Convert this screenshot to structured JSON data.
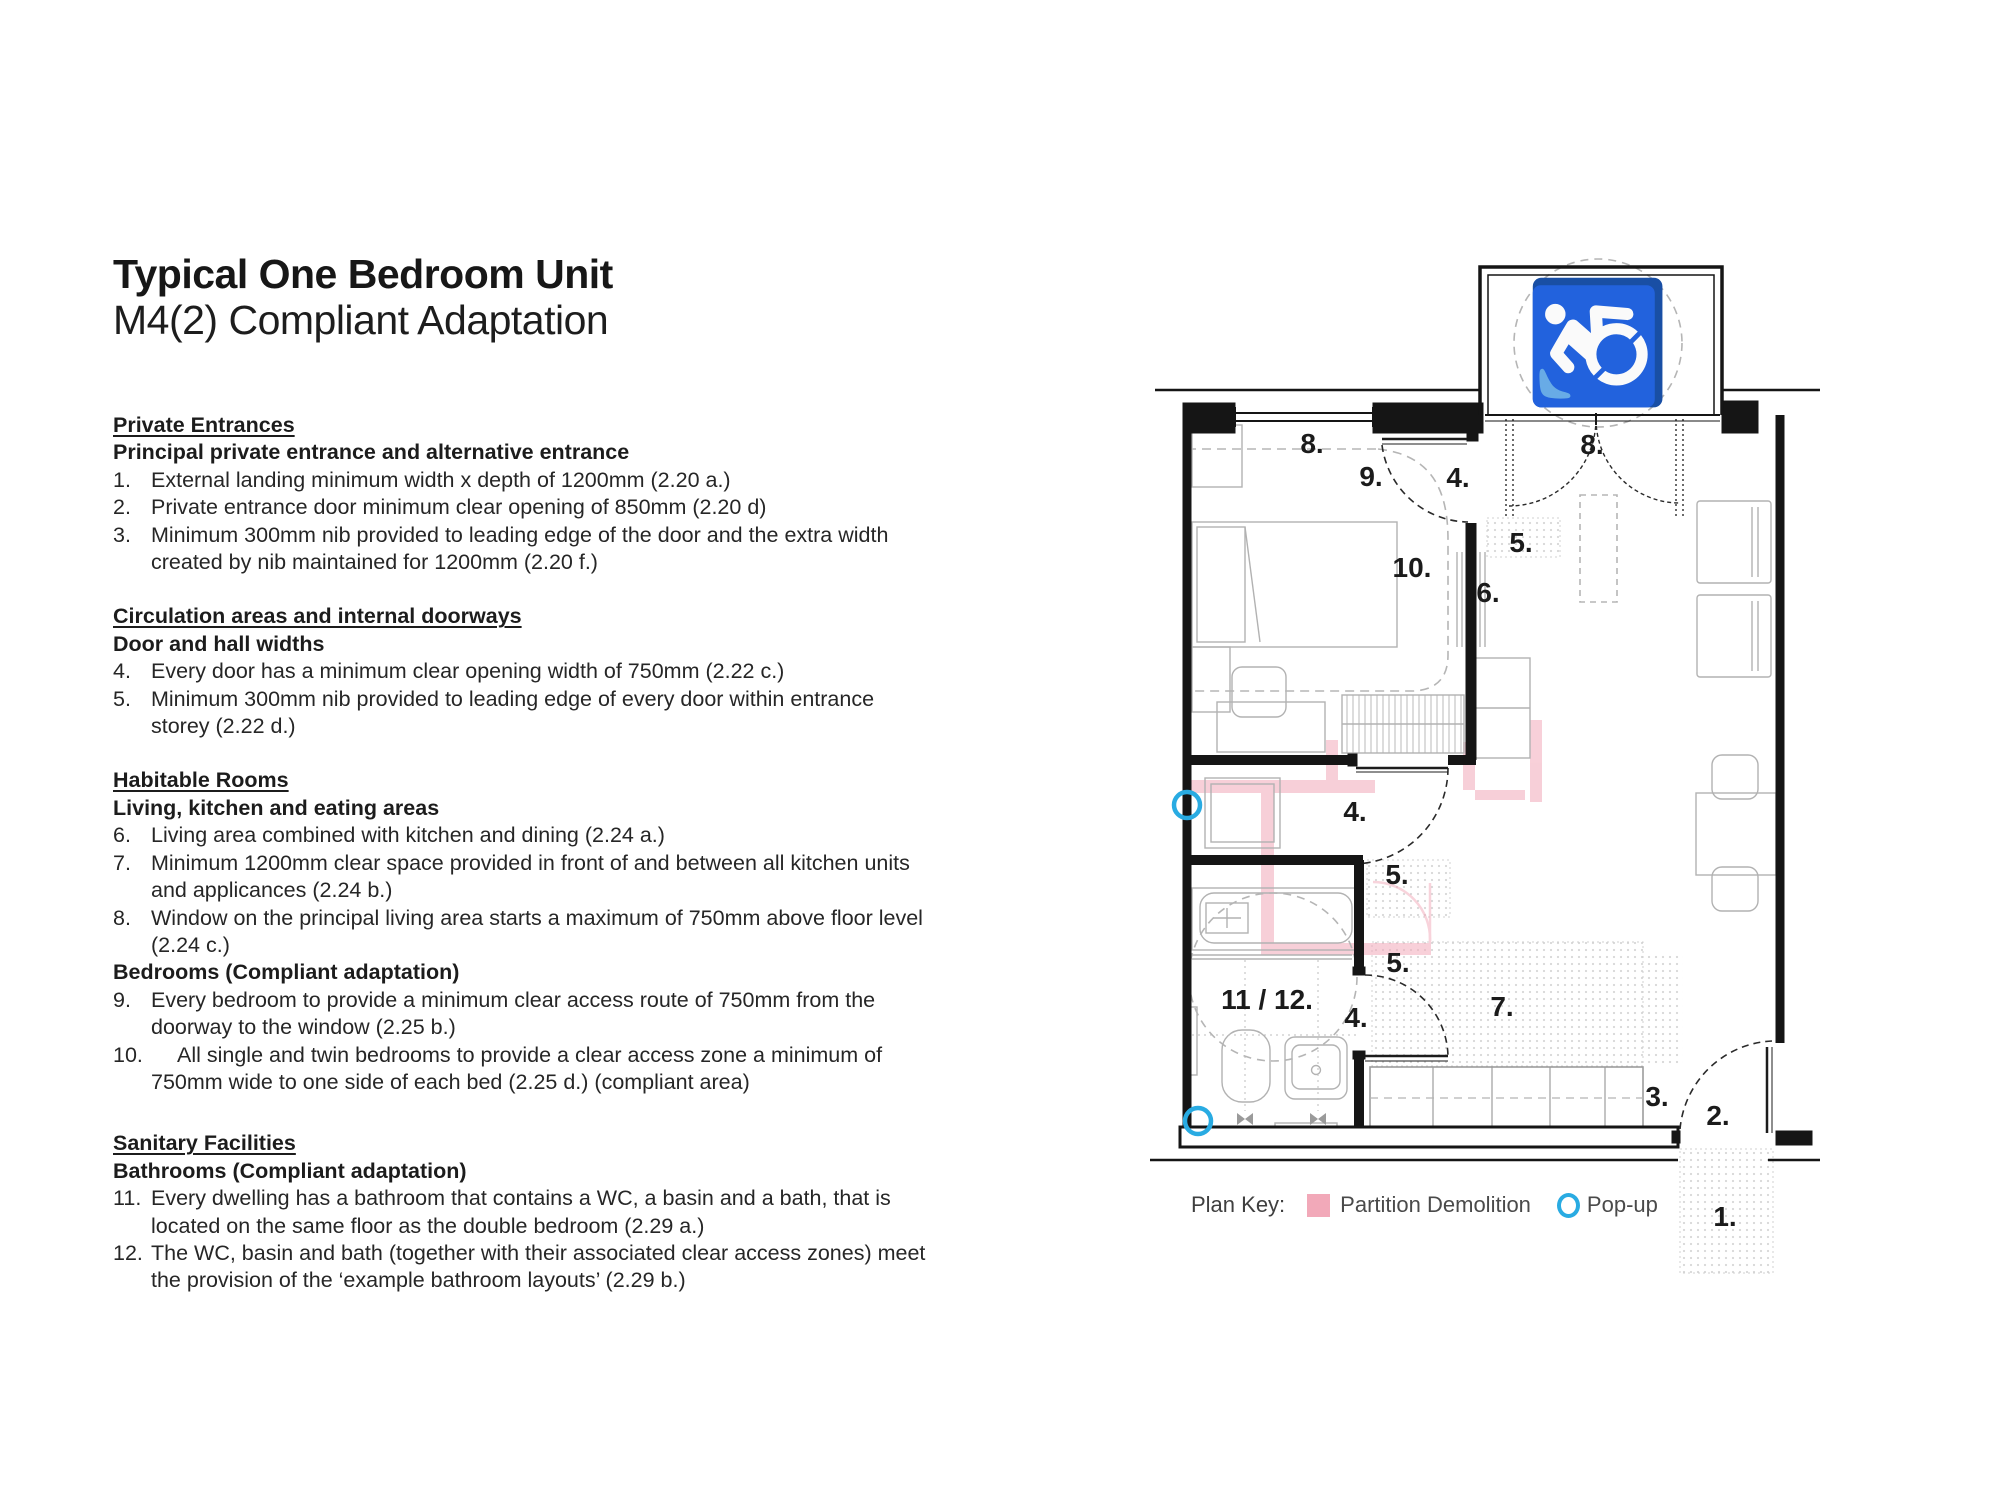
{
  "title": {
    "line1": "Typical One Bedroom Unit",
    "line2": "M4(2) Compliant Adaptation"
  },
  "sections": [
    {
      "heading": "Private Entrances",
      "subheading": "Principal private entrance and alternative entrance",
      "items": [
        {
          "num": "1.",
          "text": "External landing minimum width x depth of 1200mm (2.20 a.)"
        },
        {
          "num": "2.",
          "text": "Private entrance door minimum clear opening of 850mm (2.20 d)"
        },
        {
          "num": "3.",
          "text": "Minimum 300mm nib provided to leading edge of the door and the extra width created by nib maintained for 1200mm (2.20 f.)"
        }
      ]
    },
    {
      "heading": "Circulation areas and internal doorways",
      "subheading": "Door and hall widths",
      "items": [
        {
          "num": "4.",
          "text": "Every door has a minimum clear opening width of 750mm (2.22 c.)"
        },
        {
          "num": "5.",
          "text": "Minimum 300mm nib provided to leading edge of every door within entrance storey (2.22 d.)"
        }
      ]
    },
    {
      "heading": "Habitable Rooms",
      "subheading": "Living, kitchen and eating areas",
      "items": [
        {
          "num": "6.",
          "text": "Living area combined with kitchen and dining (2.24 a.)"
        },
        {
          "num": "7.",
          "text": "Minimum 1200mm clear space provided in front of and between all kitchen units and applicances  (2.24 b.)"
        },
        {
          "num": "8.",
          "text": "Window on the principal living area starts a maximum of 750mm above floor level (2.24 c.)"
        }
      ],
      "subheading2": "Bedrooms (Compliant adaptation)",
      "items2": [
        {
          "num": "9.",
          "text": "Every bedroom to provide a minimum clear access route of 750mm from the doorway to the window (2.25 b.)"
        },
        {
          "num": "10.",
          "text": "All single and twin bedrooms to provide a clear access zone a minimum of 750mm wide to one side of each bed (2.25 d.) (compliant area)"
        }
      ]
    },
    {
      "heading": "Sanitary Facilities",
      "subheading": "Bathrooms (Compliant adaptation)",
      "items": [
        {
          "num": "11.",
          "text": "Every dwelling has a bathroom that contains a WC, a basin and a  bath, that is located on the same floor as the double bedroom (2.29 a.)"
        },
        {
          "num": "12.",
          "text": "The WC, basin and bath (together with their associated clear access zones) meet the provision of the ‘example bathroom layouts’ (2.29 b.)"
        }
      ]
    }
  ],
  "plan_key": {
    "label": "Plan Key:",
    "partition_demolition": "Partition Demolition",
    "popup": "Pop-up",
    "partition_color": "#F2A9B9",
    "popup_color": "#29ABE2"
  },
  "plan": {
    "wheelchair_icon": "♿",
    "labels": [
      {
        "id": "window-route",
        "text": "8."
      },
      {
        "id": "bedroom-access-route",
        "text": "9."
      },
      {
        "id": "bedroom-door",
        "text": "4."
      },
      {
        "id": "living-window",
        "text": "8."
      },
      {
        "id": "entry-nib",
        "text": "5."
      },
      {
        "id": "bed-access-zone",
        "text": "10."
      },
      {
        "id": "living-kitchen-dining",
        "text": "6."
      },
      {
        "id": "hall-door",
        "text": "4."
      },
      {
        "id": "hall-nib-upper",
        "text": "5."
      },
      {
        "id": "hall-nib-lower",
        "text": "5."
      },
      {
        "id": "bathroom",
        "text": "11 / 12."
      },
      {
        "id": "bathroom-door",
        "text": "4."
      },
      {
        "id": "kitchen-clear-space",
        "text": "7."
      },
      {
        "id": "entrance-nib",
        "text": "3."
      },
      {
        "id": "entrance-door",
        "text": "2."
      },
      {
        "id": "external-landing",
        "text": "1."
      }
    ]
  }
}
